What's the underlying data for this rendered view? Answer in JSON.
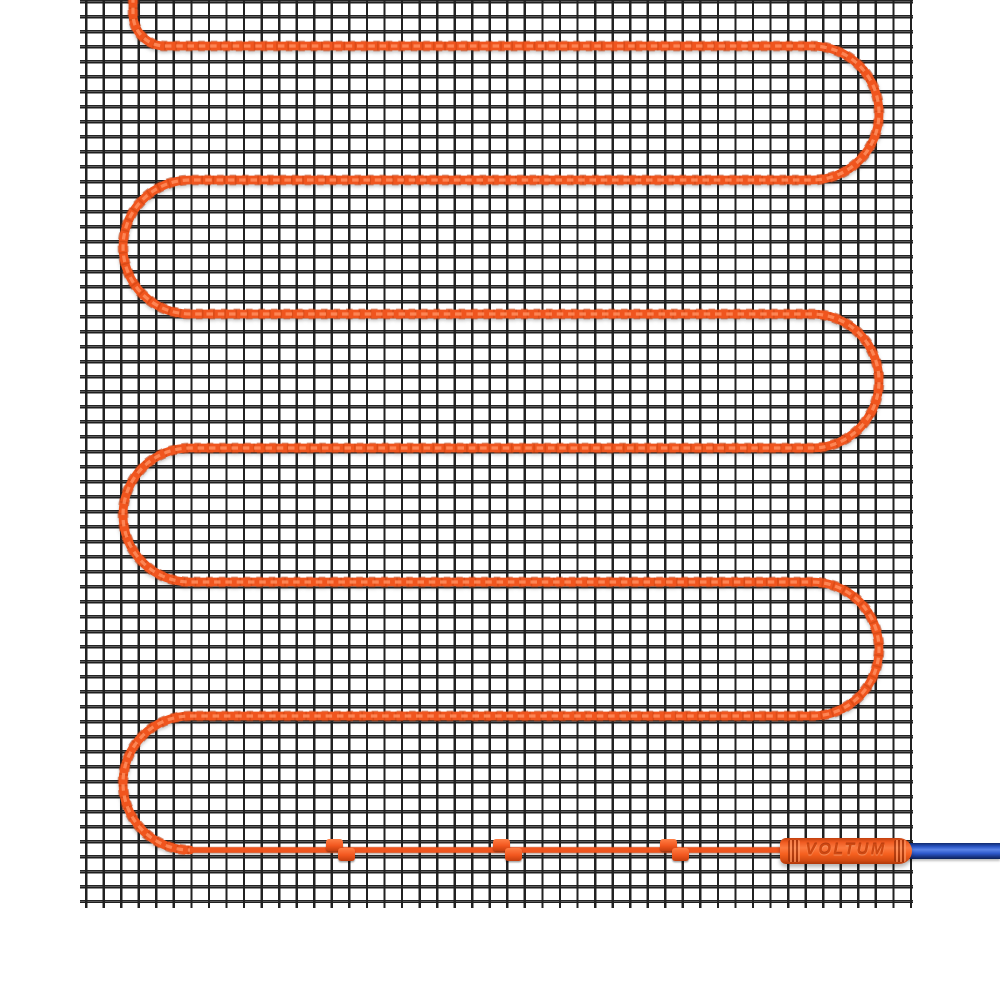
{
  "product": {
    "brand_label": "VOLTUM",
    "description": "electric underfloor heating mat on mesh with cold lead"
  },
  "colors": {
    "heating_cable": "#F0551E",
    "cable_highlight": "#FF8E5E",
    "cable_shadow": "#BC3B0C",
    "cold_lead_blue": "#2E5BD0",
    "mesh_line": "#212121",
    "background": "#FFFFFF"
  },
  "mesh": {
    "left": 80,
    "top": 0,
    "right": 913,
    "bottom": 908,
    "cell_width": 17.55,
    "cell_height": 15
  },
  "cable": {
    "entry_x": 133,
    "entry_top_y": -15,
    "entry_radius": 32,
    "runs_y": [
      46,
      180,
      314,
      448,
      582,
      716,
      850
    ],
    "left_x": 190,
    "right_x": 812,
    "turn_radius": 67,
    "lead_end_x": 788
  },
  "clips_x": [
    341,
    508,
    675
  ],
  "connector": {
    "x": 780,
    "y": 838,
    "width": 132,
    "height": 26
  },
  "blue_cable": {
    "x": 905,
    "y": 843,
    "width": 95,
    "height": 16
  }
}
